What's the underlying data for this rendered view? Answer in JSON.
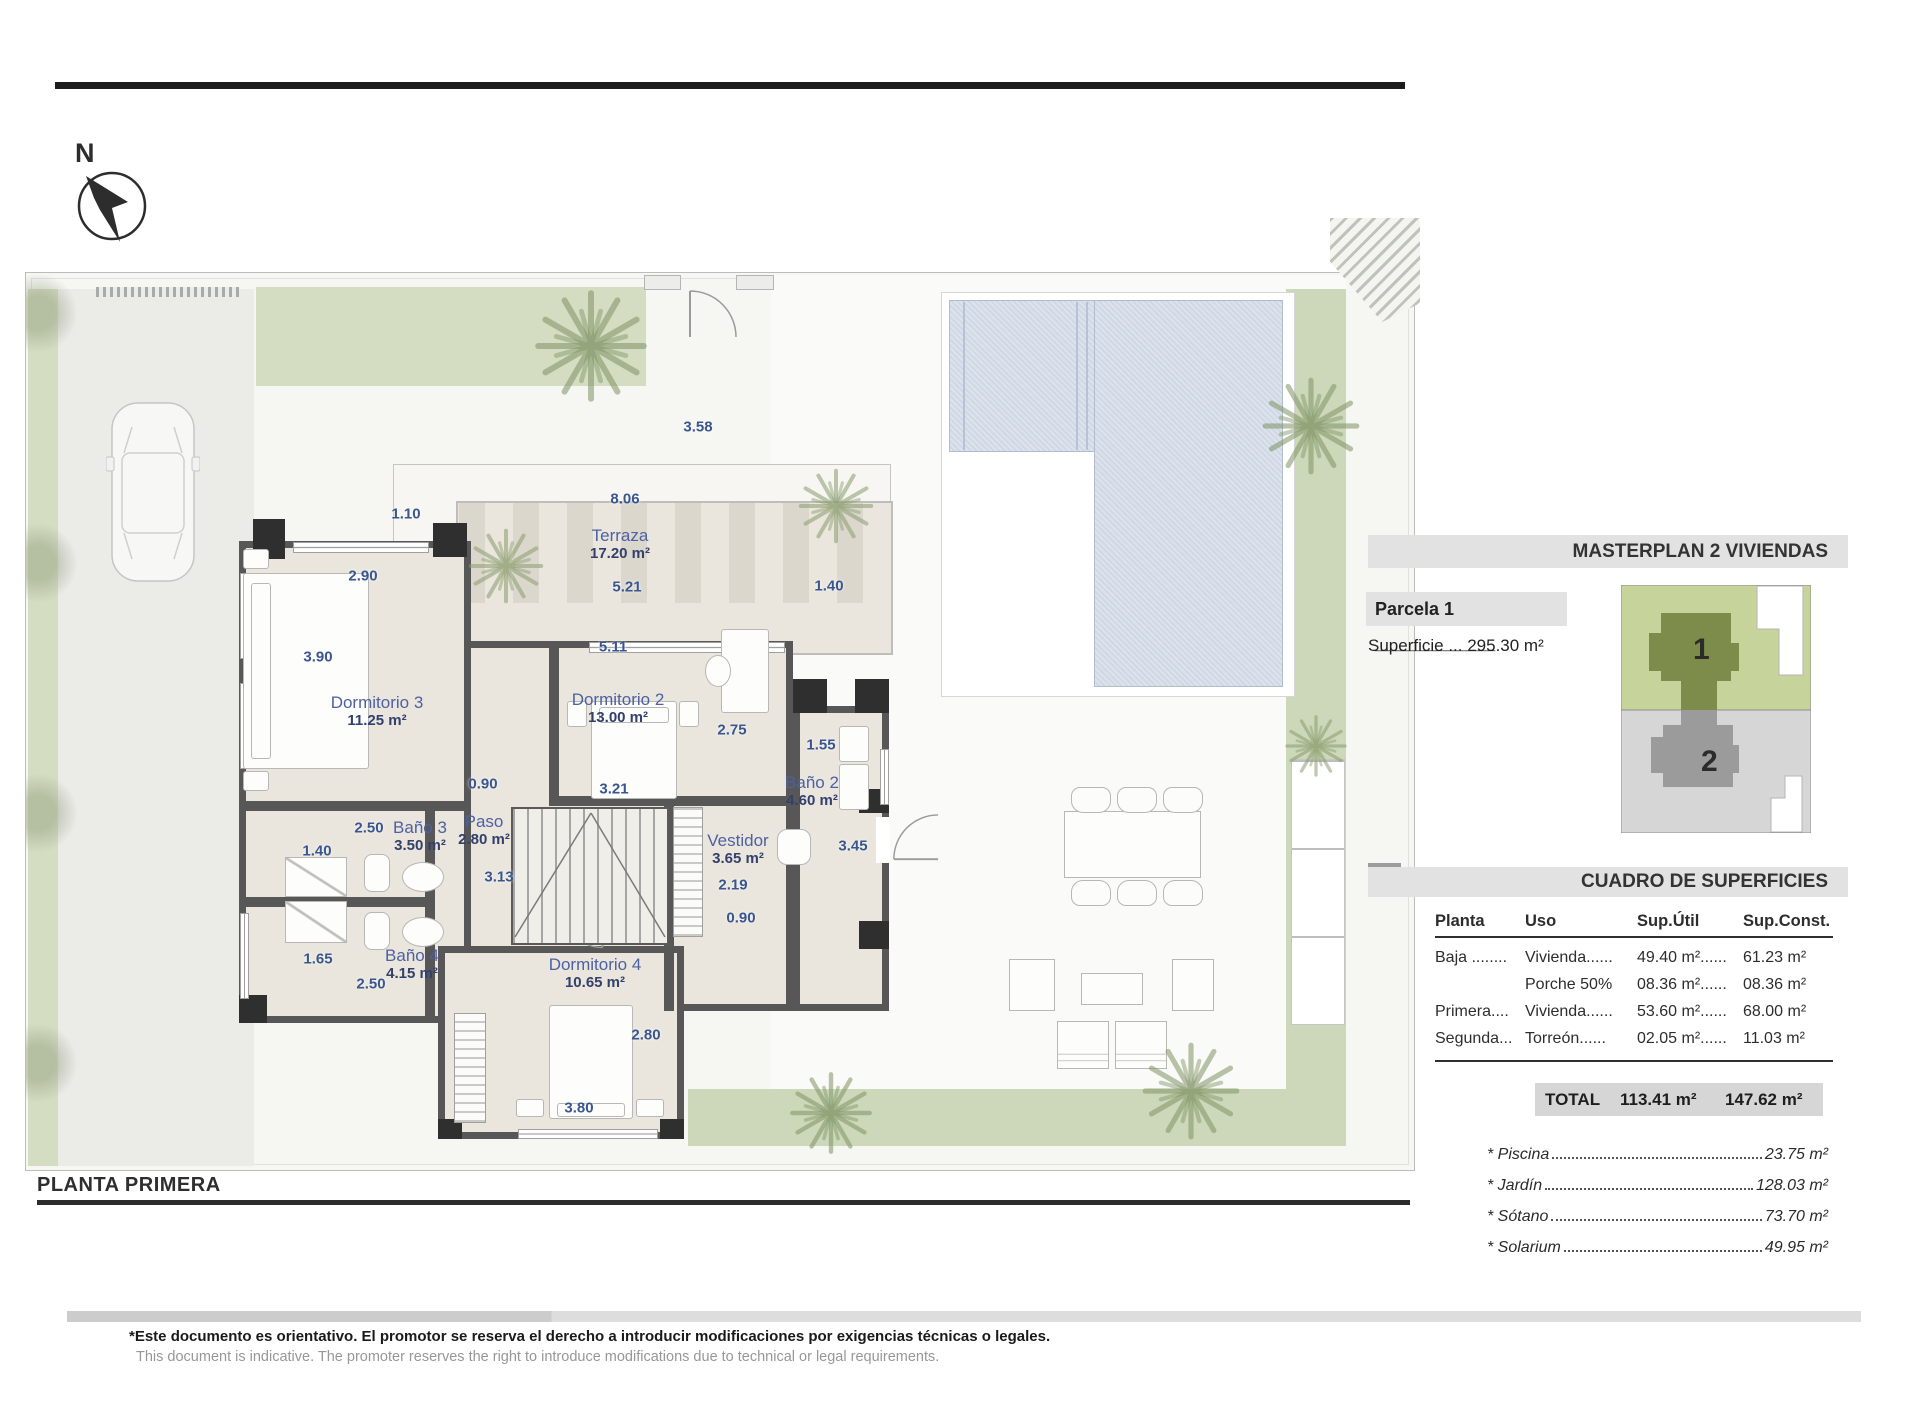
{
  "north": {
    "label": "N"
  },
  "plan": {
    "title": "PLANTA PRIMERA",
    "rooms": [
      {
        "name": "Terraza",
        "area": "17.20 m²"
      },
      {
        "name": "Dormitorio 3",
        "area": "11.25 m²"
      },
      {
        "name": "Dormitorio 2",
        "area": "13.00 m²"
      },
      {
        "name": "Baño 3",
        "area": "3.50 m²"
      },
      {
        "name": "Paso",
        "area": "2.80 m²"
      },
      {
        "name": "Vestidor",
        "area": "3.65 m²"
      },
      {
        "name": "Baño 2",
        "area": "4.60 m²"
      },
      {
        "name": "Baño 4",
        "area": "4.15 m²"
      },
      {
        "name": "Dormitorio 4",
        "area": "10.65 m²"
      }
    ],
    "dimensions": [
      "8.06",
      "1.10",
      "3.58",
      "2.90",
      "5.21",
      "1.40",
      "5.11",
      "3.90",
      "2.75",
      "1.55",
      "0.90",
      "3.21",
      "2.50",
      "1.40",
      "3.13",
      "3.45",
      "2.19",
      "0.90",
      "1.65",
      "2.50",
      "2.80",
      "3.80"
    ]
  },
  "sidebar": {
    "masterplan_title": "MASTERPLAN 2 VIVIENDAS",
    "parcela_label": "Parcela 1 ____________",
    "superficie": "Superficie ... 295.30 m²",
    "unit1": "1",
    "unit2": "2",
    "cuadro_title": "CUADRO DE SUPERFICIES",
    "table": {
      "headers": [
        "Planta",
        "Uso",
        "Sup.Útil",
        "Sup.Const."
      ],
      "rows": [
        [
          "Baja ........",
          "Vivienda......",
          "49.40 m²......",
          "61.23 m²"
        ],
        [
          "",
          "Porche 50%",
          "08.36 m²......",
          "08.36 m²"
        ],
        [
          "Primera....",
          "Vivienda......",
          "53.60 m²......",
          "68.00 m²"
        ],
        [
          "Segunda...",
          "Torreón......",
          "02.05 m²......",
          "11.03 m²"
        ]
      ],
      "total_label": "TOTAL",
      "total_util": "113.41 m²",
      "total_const": "147.62 m²"
    },
    "extras": [
      {
        "label": "* Piscina",
        "value": "23.75 m²"
      },
      {
        "label": "* Jardín",
        "value": "128.03 m²"
      },
      {
        "label": "* Sótano",
        "value": "73.70 m²"
      },
      {
        "label": "* Solarium",
        "value": "49.95 m²"
      }
    ]
  },
  "footer": {
    "line1": "*Este documento es orientativo. El promotor se reserva el derecho a introducir modificaciones por exigencias técnicas o legales.",
    "line2": "This document is indicative. The promoter reserves the right to introduce modifications due to technical or legal requirements."
  }
}
